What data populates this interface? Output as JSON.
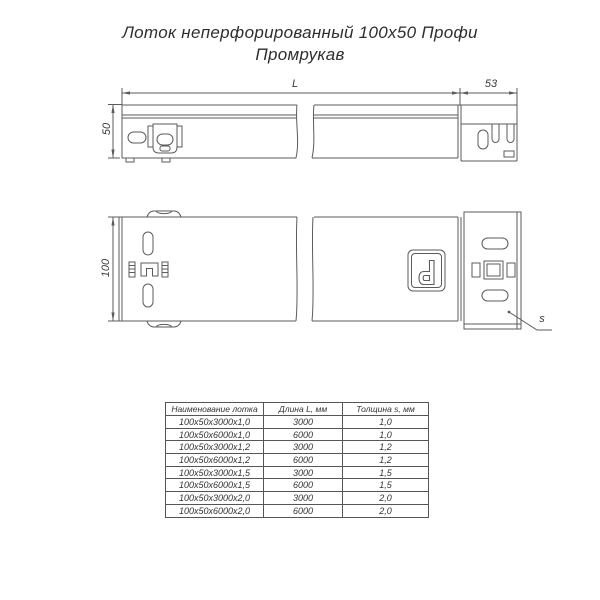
{
  "title": {
    "line1": "Лоток неперфорированный 100х50 Профи",
    "line2": "Промрукав"
  },
  "drawings": {
    "side_view": {
      "dim_length_label": "L",
      "dim_connector_width": "53",
      "dim_height": "50"
    },
    "top_view": {
      "dim_width": "100",
      "dim_thickness_label": "s"
    }
  },
  "table": {
    "headers": [
      "Наименование лотка",
      "Длина L, мм",
      "Толщина s, мм"
    ],
    "rows": [
      [
        "100х50х3000х1,0",
        "3000",
        "1,0"
      ],
      [
        "100х50х6000х1,0",
        "6000",
        "1,0"
      ],
      [
        "100х50х3000х1,2",
        "3000",
        "1,2"
      ],
      [
        "100х50х6000х1,2",
        "6000",
        "1,2"
      ],
      [
        "100х50х3000х1,5",
        "3000",
        "1,5"
      ],
      [
        "100х50х6000х1,5",
        "6000",
        "1,5"
      ],
      [
        "100х50х3000х2,0",
        "3000",
        "2,0"
      ],
      [
        "100х50х6000х2,0",
        "6000",
        "2,0"
      ]
    ]
  },
  "colors": {
    "line": "#5b5b5b",
    "text": "#333333",
    "background": "#ffffff"
  }
}
